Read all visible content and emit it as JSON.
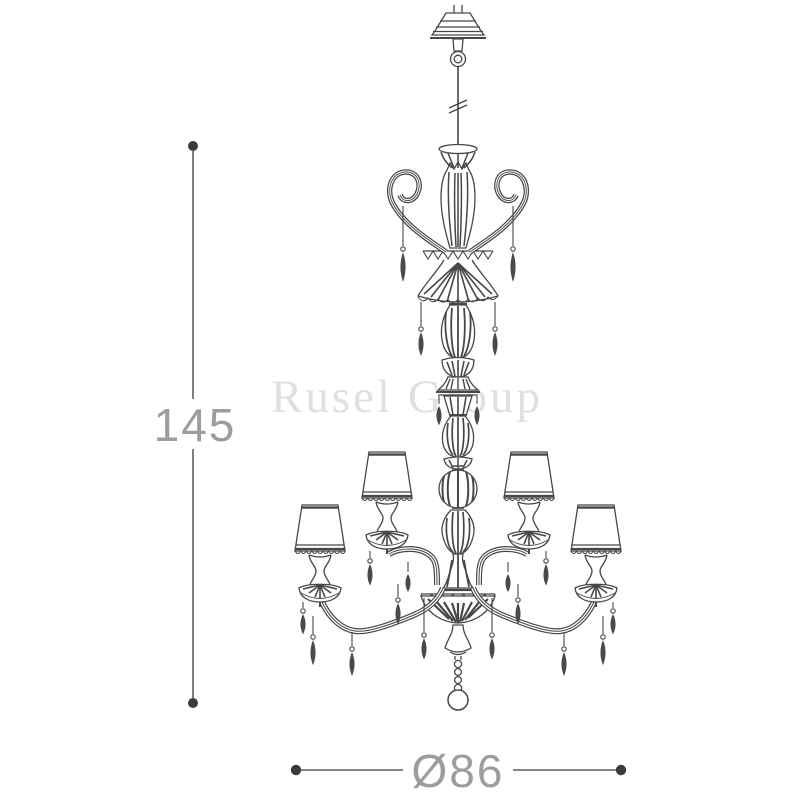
{
  "watermark": {
    "text": "Rusel Group",
    "color": "#e2e0dd"
  },
  "dimensions": {
    "height": {
      "value": "145",
      "orientation": "vertical"
    },
    "diameter": {
      "value": "Ø86",
      "orientation": "horizontal"
    }
  },
  "drawing": {
    "subject": "two-tier chandelier with four visible lampshades, crystal pendant drops, scroll crown, bead-chain finial ball — technical line drawing",
    "line_color": "#474747",
    "pendant_fill": "#4a4a4a",
    "dimension_line_color": "#5f5f5f",
    "dimension_dot_color": "#3a3a3a",
    "dimension_text_color": "#9d9d9d",
    "background": "#ffffff"
  }
}
